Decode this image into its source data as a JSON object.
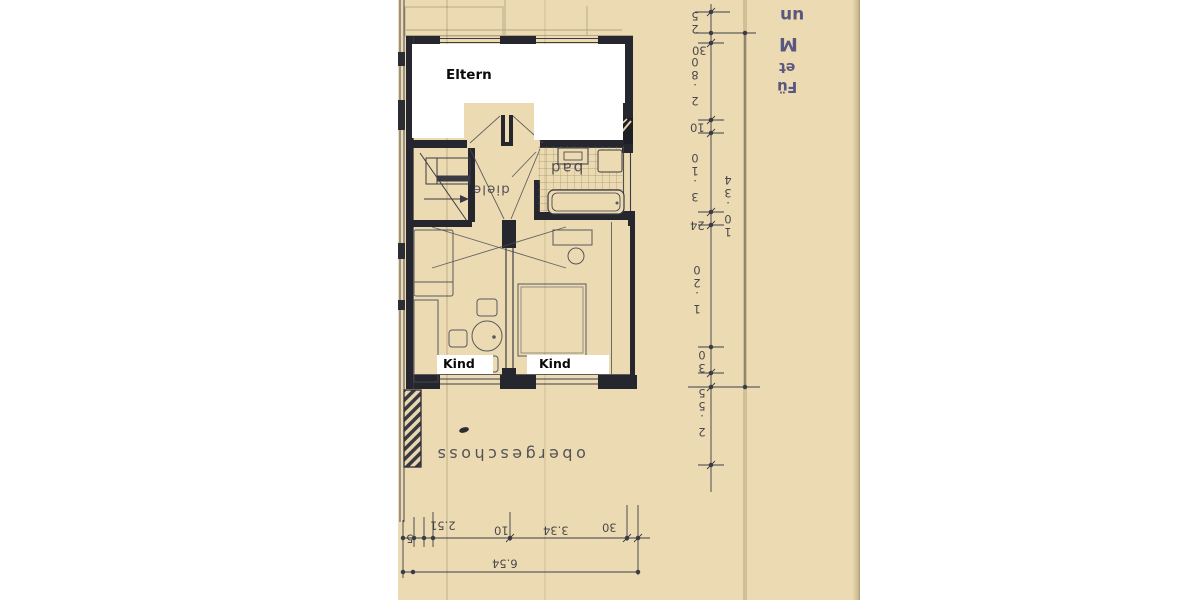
{
  "labels": {
    "eltern": "Eltern",
    "kind_left": "Kind",
    "kind_right": "Kind",
    "bad": "bad",
    "diele": "diele",
    "floor_title": "obergeschoss"
  },
  "dimensions": {
    "right_chain": [
      "25",
      "30",
      "2.80",
      "10",
      "3.10",
      "24",
      "1.20",
      "30",
      "2.55"
    ],
    "right_total": "10.34",
    "bottom_chain": [
      "2.51",
      "5",
      "10",
      "3.34",
      "30"
    ],
    "bottom_total": "6.54"
  },
  "notes_blue": [
    "un",
    "M",
    "et",
    "Fü"
  ],
  "colors": {
    "paper": "#ecdbb2",
    "ink": "#2c2c34",
    "blue_note": "#4d4d7d",
    "redaction": "#ffffff"
  }
}
